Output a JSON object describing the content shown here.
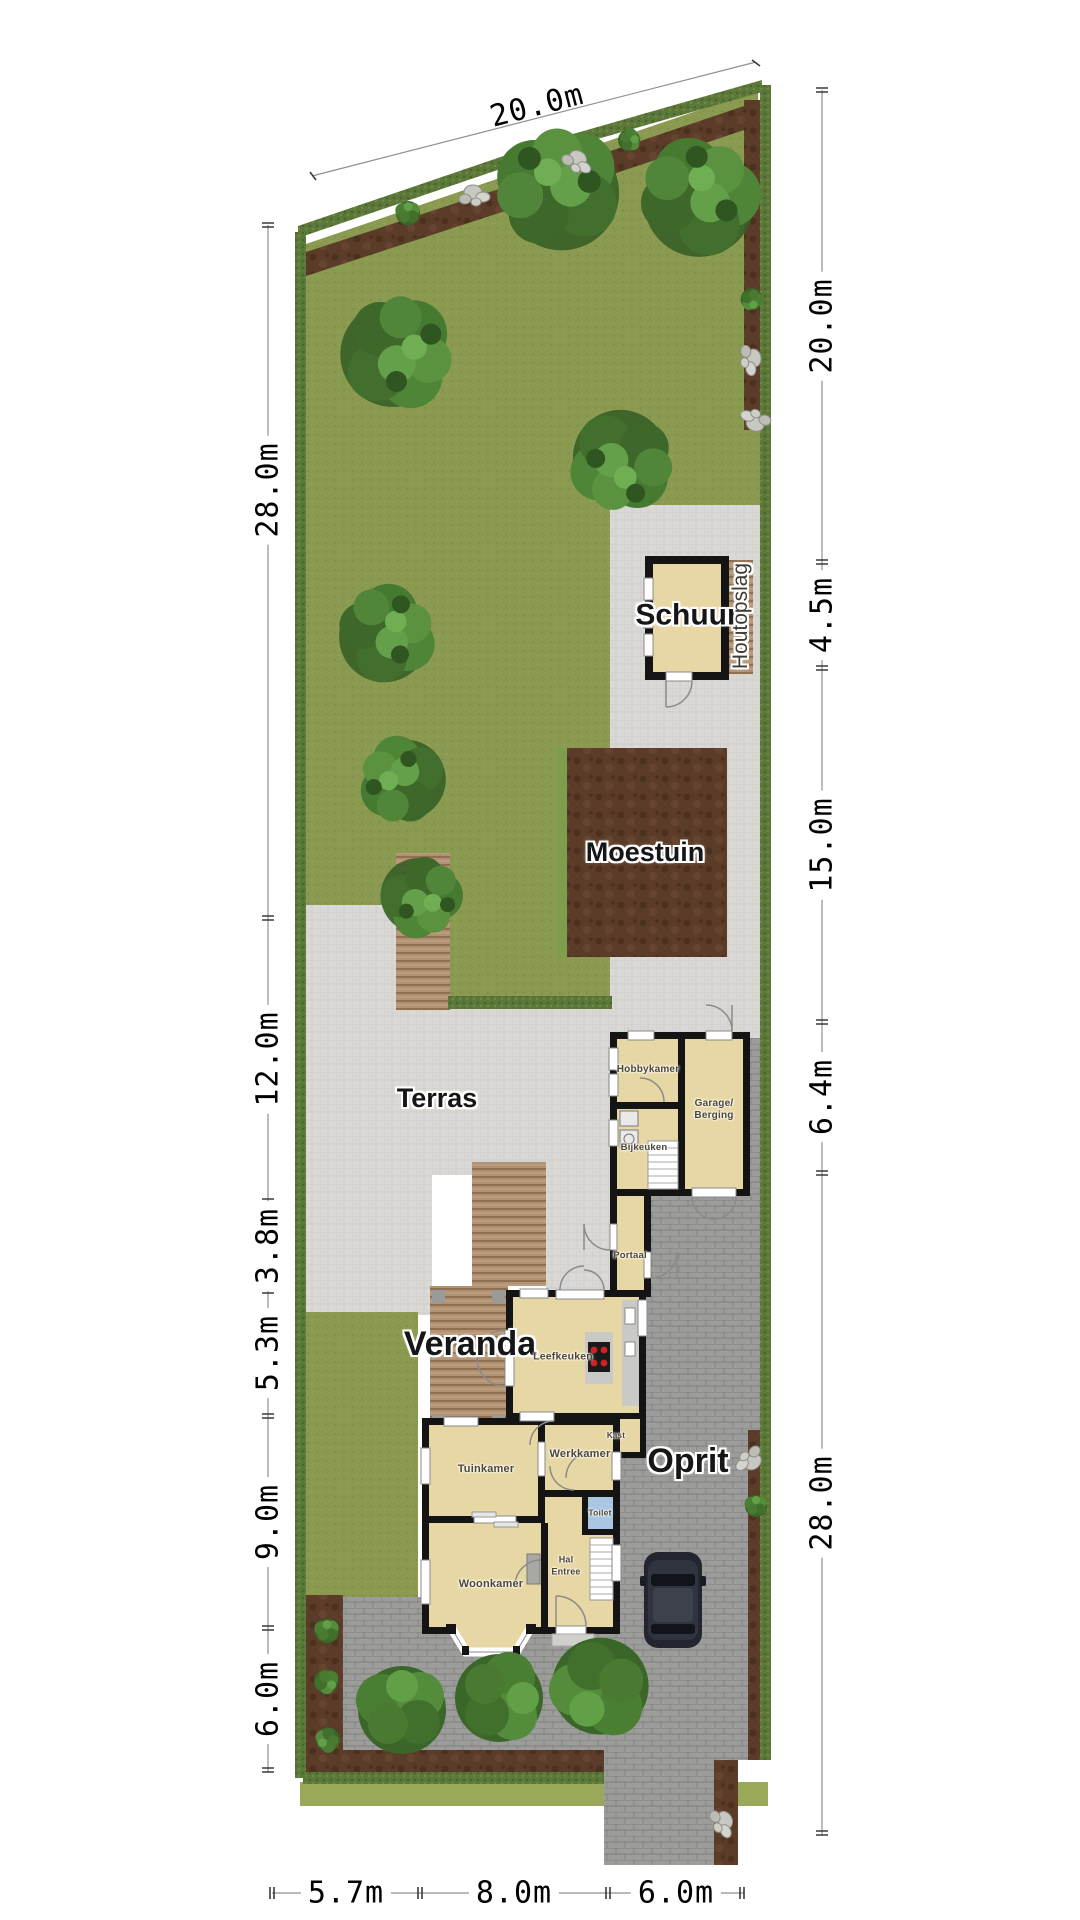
{
  "title": "Site plan with garden and ground floor",
  "dimensions": {
    "top": "20.0m",
    "left": [
      "28.0m",
      "12.0m",
      "3.8m",
      "5.3m",
      "9.0m",
      "6.0m"
    ],
    "right": [
      "20.0m",
      "4.5m",
      "15.0m",
      "6.4m",
      "28.0m"
    ],
    "bottom": [
      "5.7m",
      "8.0m",
      "6.0m"
    ]
  },
  "site": {
    "areas": {
      "terras": "Terras",
      "veranda": "Veranda",
      "oprit": "Oprit",
      "schuur": "Schuur",
      "houtopslag": "Houtopslag",
      "moestuin": "Moestuin"
    },
    "rooms": {
      "hobbykamer": "Hobbykamer",
      "garage_line1": "Garage/",
      "garage_line2": "Berging",
      "bijkeuken": "Bijkeuken",
      "portaal": "Portaal",
      "leefkeuken": "Leefkeuken",
      "kast": "Kast",
      "tuinkamer": "Tuinkamer",
      "werkkamer": "Werkkamer",
      "toilet": "Toilet",
      "hal_line1": "Hal",
      "hal_line2": "Entree",
      "woonkamer": "Woonkamer"
    }
  },
  "colors": {
    "lawn": "#8a9a50",
    "hedge": "#5c7839",
    "soil": "#5b3c28",
    "terras_paving": "#d9d8d4",
    "oprit_paving": "#9c9c9a",
    "wood_deck": "#b29274",
    "wall": "#141414",
    "room_fill": "#e7d7a4",
    "toilet_fill": "#a9c7e2",
    "stove_burner": "#cc2222",
    "tree_green": "#4a7f33",
    "stone": "#c8c8c2",
    "car_body": "#2b2f38",
    "dimension_text": "#000000"
  }
}
